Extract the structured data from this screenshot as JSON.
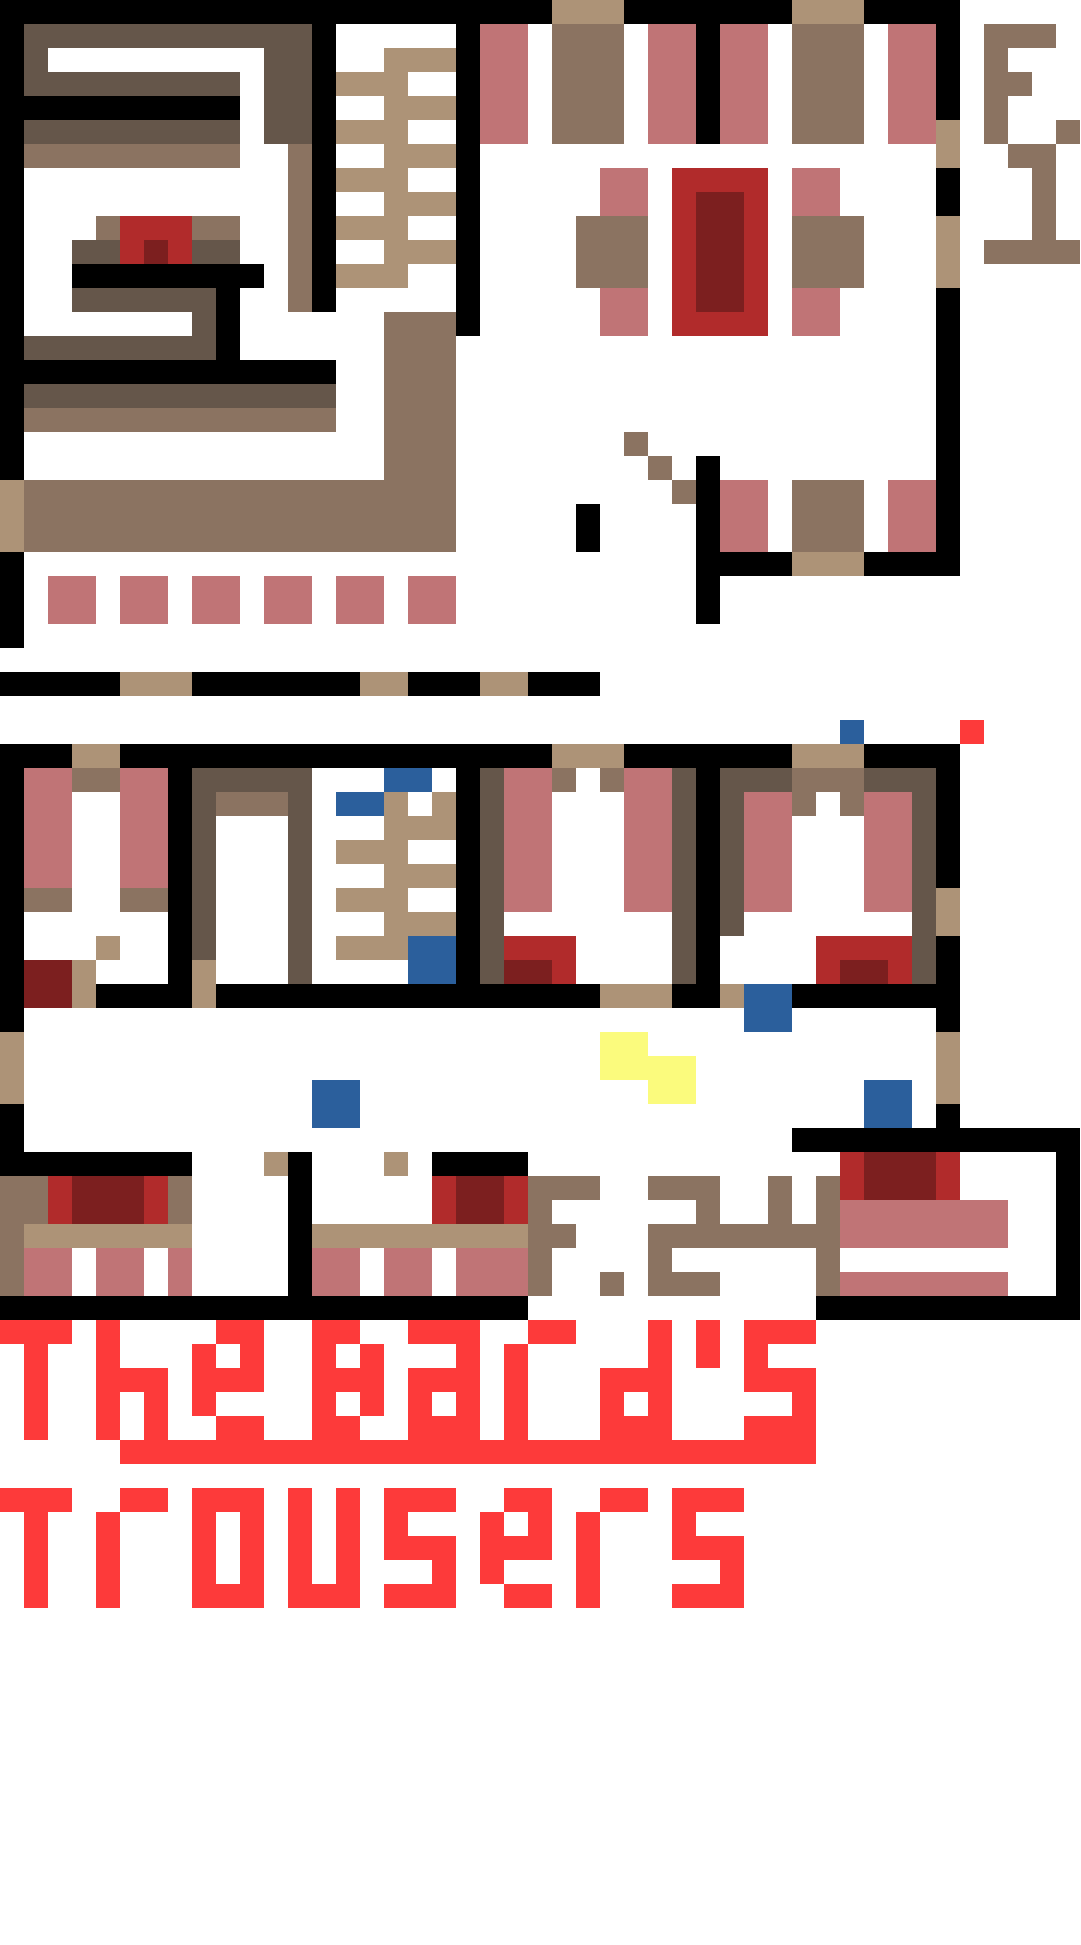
{
  "map": {
    "name": "The Bard's Trowsers tavern floor plan",
    "floor1_label": "F. 1",
    "floors_2_4_label": "F.2-4",
    "title_line1": "The Bard's",
    "title_line2": "Trowsers"
  },
  "palette": {
    "K": "#000000",
    "W": "#ffffff",
    "D": "#65564a",
    "M": "#8b7361",
    "T": "#ad9377",
    "P": "#c07476",
    "R": "#b12b2b",
    "E": "#7c1f1f",
    "B": "#2b5f9c",
    "Y": "#fbfb7d",
    "F": "#fd3a3a"
  },
  "palette_legend": {
    "K": "wall-black",
    "W": "floor-white",
    "D": "dark-brown-wall",
    "M": "brown-furniture",
    "T": "tan-door-stairs",
    "P": "pink-seat-bed",
    "R": "red-table-bed",
    "E": "dark-red-inner",
    "B": "blue-marker",
    "Y": "yellow-marker",
    "F": "bright-red-accent"
  },
  "grid": {
    "cell_size": 24,
    "cols": 45,
    "rows": 81,
    "rows_data": [
      "KKKKKKKKKKKKKKKKKKKKKKKTTTKKKKKKKTTTKKKKWWWWW",
      "KDDDDDDDDDDDDKWWWWWKPPWMMMWPPKPPWMMMWPPKWMMMW",
      "KDWWWWWWWWWDDKWWTTTKPPWMMMWPPKPPWMMMWPPKWMWWW",
      "KDDDDDDDDDWDDKTTTWWKPPWMMMWPPKPPWMMMWPPKWMMWW",
      "KKKKKKKKKKWDDKWWTTTKPPWMMMWPPKPPWMMMWPPKWMWWW",
      "KDDDDDDDDDWDDKTTTWWKPPWMMMWPPKPPWMMMWPPTWMWWM",
      "KMMMMMMMMMWWMKWWTTTKWWWWWWWWWWWWWWWWWWWTWWMMW",
      "KWWWWWWWWWWWMKTTTWWKWWWWWPPWRRRRWPPWWWWKWWWMW",
      "KWWWWWWWWWWWMKWWTTTKWWWWWPPWREERWPPWWWWKWWWMW",
      "KWWWMRRRMMWWMKTTTWWKWWWWMMMWREERWMMMWWWTWWWMW",
      "KWWDDRERDDWWMKWWTTTKWWWWMMMWREERWMMMWWWTWMMMM",
      "KWWKKKKKKKKWMKTTTWWKWWWWMMMWREERWMMMWWWTWWWWW",
      "KWWDDDDDDKWWMKWWWWWKWWWWWPPWREERWPPWWWWKWWWWW",
      "KWWWWWWWDKWWWWWWMMMKWWWWWPPWRRRRWPPWWWWKWWWWW",
      "KDDDDDDDDKWWWWWWMMMWWWWWWWWWWWWWWWWWWWWKWWWWW",
      "KKKKKKKKKKKKKKWWMMMWWWWWWWWWWWWWWWWWWWWKWWWWW",
      "KDDDDDDDDDDDDDWWMMMWWWWWWWWWWWWWWWWWWWWKWWWWW",
      "KMMMMMMMMMMMMMWWMMMWWWWWWWWWWWWWWWWWWWWKWWWWW",
      "KWWWWWWWWWWWWWWWMMMWWWWWWWMWWWWWWWWWWWWKWWWWW",
      "KWWWWWWWWWWWWWWWMMMWWWWWWWWMWKWWWWWWWWWKWWWWW",
      "TMMMMMMMMMMMMMMMMMMWWWWWWWWWMKPPWMMMWPPKWWWWW",
      "TMMMMMMMMMMMMMMMMMMWWWWWKWWWWKPPWMMMWPPKWWWWW",
      "TMMMMMMMMMMMMMMMMMMWWWWWKWWWWKPPWMMMWPPKWWWWW",
      "KWWWWWWWWWWWWWWWWWWWWWWWWWWWWKKKKTTTKKKKWWWWW",
      "KWPPWPPWPPWPPWPPWPPWWWWWWWWWWKWWWWWWWWWWWWWWW",
      "KWPPWPPWPPWPPWPPWPPWWWWWWWWWWKWWWWWWWWWWWWWWW",
      "KWWWWWWWWWWWWWWWWWWWWWWWWWWWWWWWWWWWWWWWWWWWW",
      "WWWWWWWWWWWWWWWWWWWWWWWWWWWWWWWWWWWWWWWWWWWWW",
      "KKKKKTTTKKKKKKKTTKKKTTKKKWWWWWWWWWWWWWWWWWWWW",
      "WWWWWWWWWWWWWWWWWWWWWWWWWWWWWWWWWWWWWWWWWWWWW",
      "WWWWWWWWWWWWWWWWWWWWWWWWWWWWWWWWWWWBWWWWFWWWW",
      "KKKTTKKKKKKKKKKKKKKKKKKTTTKKKKKKKTTTKKKKWWWWW",
      "KPPMMPPKDDDDDWWWBBWKDPPMWMPPDKDDDMMMDDDKWWWWW",
      "KPPWWPPKDMMMDWBBTWTKDPPWWWPPDKDPPMWMPPDKWWWWW",
      "KPPWWPPKDWWWDWWWTTTKDPPWWWPPDKDPPWWWPPDKWWWWW",
      "KPPWWPPKDWWWDWTTTWWKDPPWWWPPDKDPPWWWPPDKWWWWW",
      "KPPWWPPKDWWWDWWWTTTKDPPWWWPPDKDPPWWWPPDKWWWWW",
      "KMMWWMMKDWWWDWTTTWWKDPPWWWPPDKDPPWWWPPDTWWWWW",
      "KWWWWWWKDWWWDWWWTTTKDWWWWWWWDKDWWWWWWWDTWWWWW",
      "KWWWTWWKDWWWDWTTTBBKDRRRWWWWDKWWWWRRRRDKWWWWW",
      "KEETWWWKTWWWDWWWWBBKDEERWWWWDKWWWWREERDKWWWWW",
      "KEETKKKKTKKKKKKKKKKKKKKKKTTTKKTBBKKKKKKKWWWWW",
      "KWWWWWWWWWWWWWWWWWWWWWWWWWWWWWWBBWWWWWWKWWWWW",
      "TWWWWWWWWWWWWWWWWWWWWWWWWYYWWWWWWWWWWWWTWWWWW",
      "TWWWWWWWWWWWWWWWWWWWWWWWWYYYYWWWWWWWWWWTWWWWW",
      "TWWWWWWWWWWWWBBWWWWWWWWWWWWYYWWWWWWWBBWTWWWWW",
      "KWWWWWWWWWWWWBBWWWWWWWWWWWWWWWWWWWWWBBWKWWWWW",
      "KWWWWWWWWWWWWWWWWWWWWWWWWWWWWWWWWKKKKKKKKKKKK",
      "KKKKKKKKWWWTKWWWTWKKKKWWWWWWWWWWWWWREEERWWWWK",
      "MMREEERMWWWWKWWWWWREERMMMWWMMMWWMWMREEERWWWWK",
      "MMREEERMWWWWKWWWWWREERMWWWWWWMWWMWMPPPPPPPWWK",
      "MTTTTTTTWWWWKTTTTTTTTTMMWWWMMMMMMMMPPPPPPPWWK",
      "MPPWPPWPWWWWKPPWPPWPPPMWWWWMWWWWWWMWWWWWWWWWK",
      "MPPWPPWPWWWWKPPWPPWPPPMWWMWMMMWWWWMPPPPPPPWWK",
      "KKKKKKKKKKKKKKKKKKKKKKWWWWWWWWWWWWKKKKKKKKKKK",
      "FFFWFWWWWFFWWFFWWFFFWWFFWWWFWFWFFFWWWWWWWWWWW",
      "WFWWFWWWFWFWWFWFWWWFWFWWWWWFWFWFWWWWWWWWWWWWW",
      "WFWWFFFWFFFWWFFFWFFFWFWWWFFFWWWFFFWWWWWWWWWWW",
      "WFWWFWFWFWWWWFWFWFWFWFWWWFWFWWWWWFWWWWWWWWWWW",
      "WFWWFWFWWFFWWFFWWFFFWFWWWFFFWWWFFFWWWWWWWWWWW",
      "WWWWWFFFFFFFFFFFFFFFFFFFFFFFFFFFFFWWWWWWWWWWW",
      "WWWWWWWWWWWWWWWWWWWWWWWWWWWWWWWWWWWWWWWWWWWWW",
      "FFFWWFFWFFFWFWFWFFFWWFFWWFFWFFFWWWWWWWWWWWWWW",
      "WFWWFWWWFWFWFWFWFWWWFWFWFWWWFWWWWWWWWWWWWWWWW",
      "WFWWFWWWFWFWFWFWFFFWFFFWFWWWFFFWWWWWWWWWWWWWW",
      "WFWWFWWWFWFWFWFWWWFWFWWWFWWWWWFWWWWWWWWWWWWWW",
      "WFWWFWWWFFFWFFFWFFFWWFFWFWWWFFFWWWWWWWWWWWWWW",
      "WWWWWWWWWWWWWWWWWWWWWWWWWWWWWWWWWWWWWWWWWWWWW",
      "WWWWWWWWWWWWWWWWWWWWWWWWWWWWWWWWWWWWWWWWWWWWW",
      "WWWWWWWWWWWWWWWWWWWWWWWWWWWWWWWWWWWWWWWWWWWWW",
      "WWWWWWWWWWWWWWWWWWWWWWWWWWWWWWWWWWWWWWWWWWWWW",
      "WWWWWWWWWWWWWWWWWWWWWWWWWWWWWWWWWWWWWWWWWWWWW",
      "WWWWWWWWWWWWWWWWWWWWWWWWWWWWWWWWWWWWWWWWWWWWW",
      "WWWWWWWWWWWWWWWWWWWWWWWWWWWWWWWWWWWWWWWWWWWWW",
      "WWWWWWWWWWWWWWWWWWWWWWWWWWWWWWWWWWWWWWWWWWWWW",
      "WWWWWWWWWWWWWWWWWWWWWWWWWWWWWWWWWWWWWWWWWWWWW",
      "WWWWWWWWWWWWWWWWWWWWWWWWWWWWWWWWWWWWWWWWWWWWW",
      "WWWWWWWWWWWWWWWWWWWWWWWWWWWWWWWWWWWWWWWWWWWWW",
      "WWWWWWWWWWWWWWWWWWWWWWWWWWWWWWWWWWWWWWWWWWWWW",
      "WWWWWWWWWWWWWWWWWWWWWWWWWWWWWWWWWWWWWWWWWWWWW",
      "WWWWWWWWWWWWWWWWWWWWWWWWWWWWWWWWWWWWWWWWWWWWW"
    ]
  }
}
